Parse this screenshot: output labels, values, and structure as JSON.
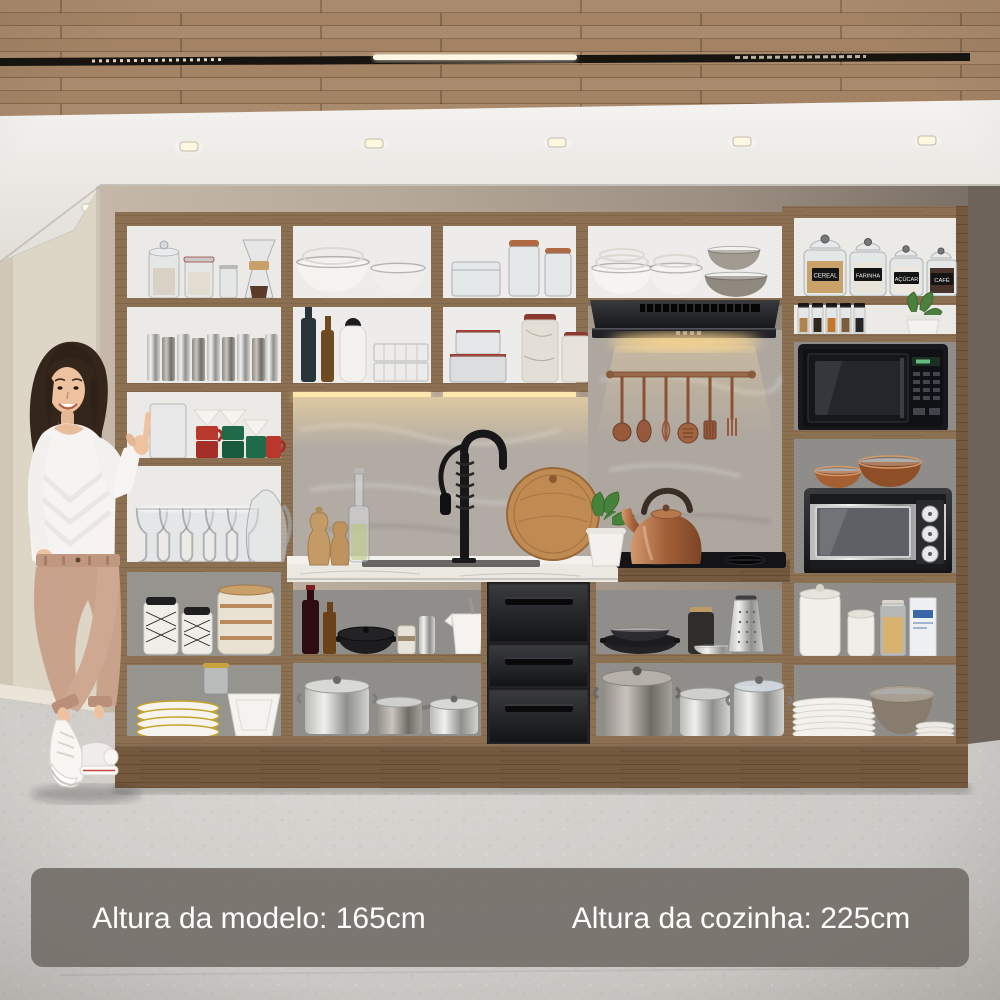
{
  "captions": {
    "model_height": "Altura da modelo: 165cm",
    "kitchen_height": "Altura da cozinha: 225cm"
  },
  "jar_labels": [
    "CEREAL",
    "FARINHA",
    "AÇÚCAR",
    "CAFÉ"
  ],
  "colors": {
    "cabinet_wood": "#8c7052",
    "plinth_wood": "#74593f",
    "ceiling_wood": "#a8876a",
    "back_wall": "#b0a294",
    "side_wall": "#ddd5c6",
    "floor": "#cccac6",
    "backsplash_marble": "#b2aba4",
    "counter_marble": "#ebe8e2",
    "appliance_black": "#17181b",
    "mug_red": "#b8382e",
    "mug_green": "#1f6b49",
    "copper": "#a45f33",
    "caption_bar": "#6f6a64",
    "caption_text": "#ffffff"
  }
}
